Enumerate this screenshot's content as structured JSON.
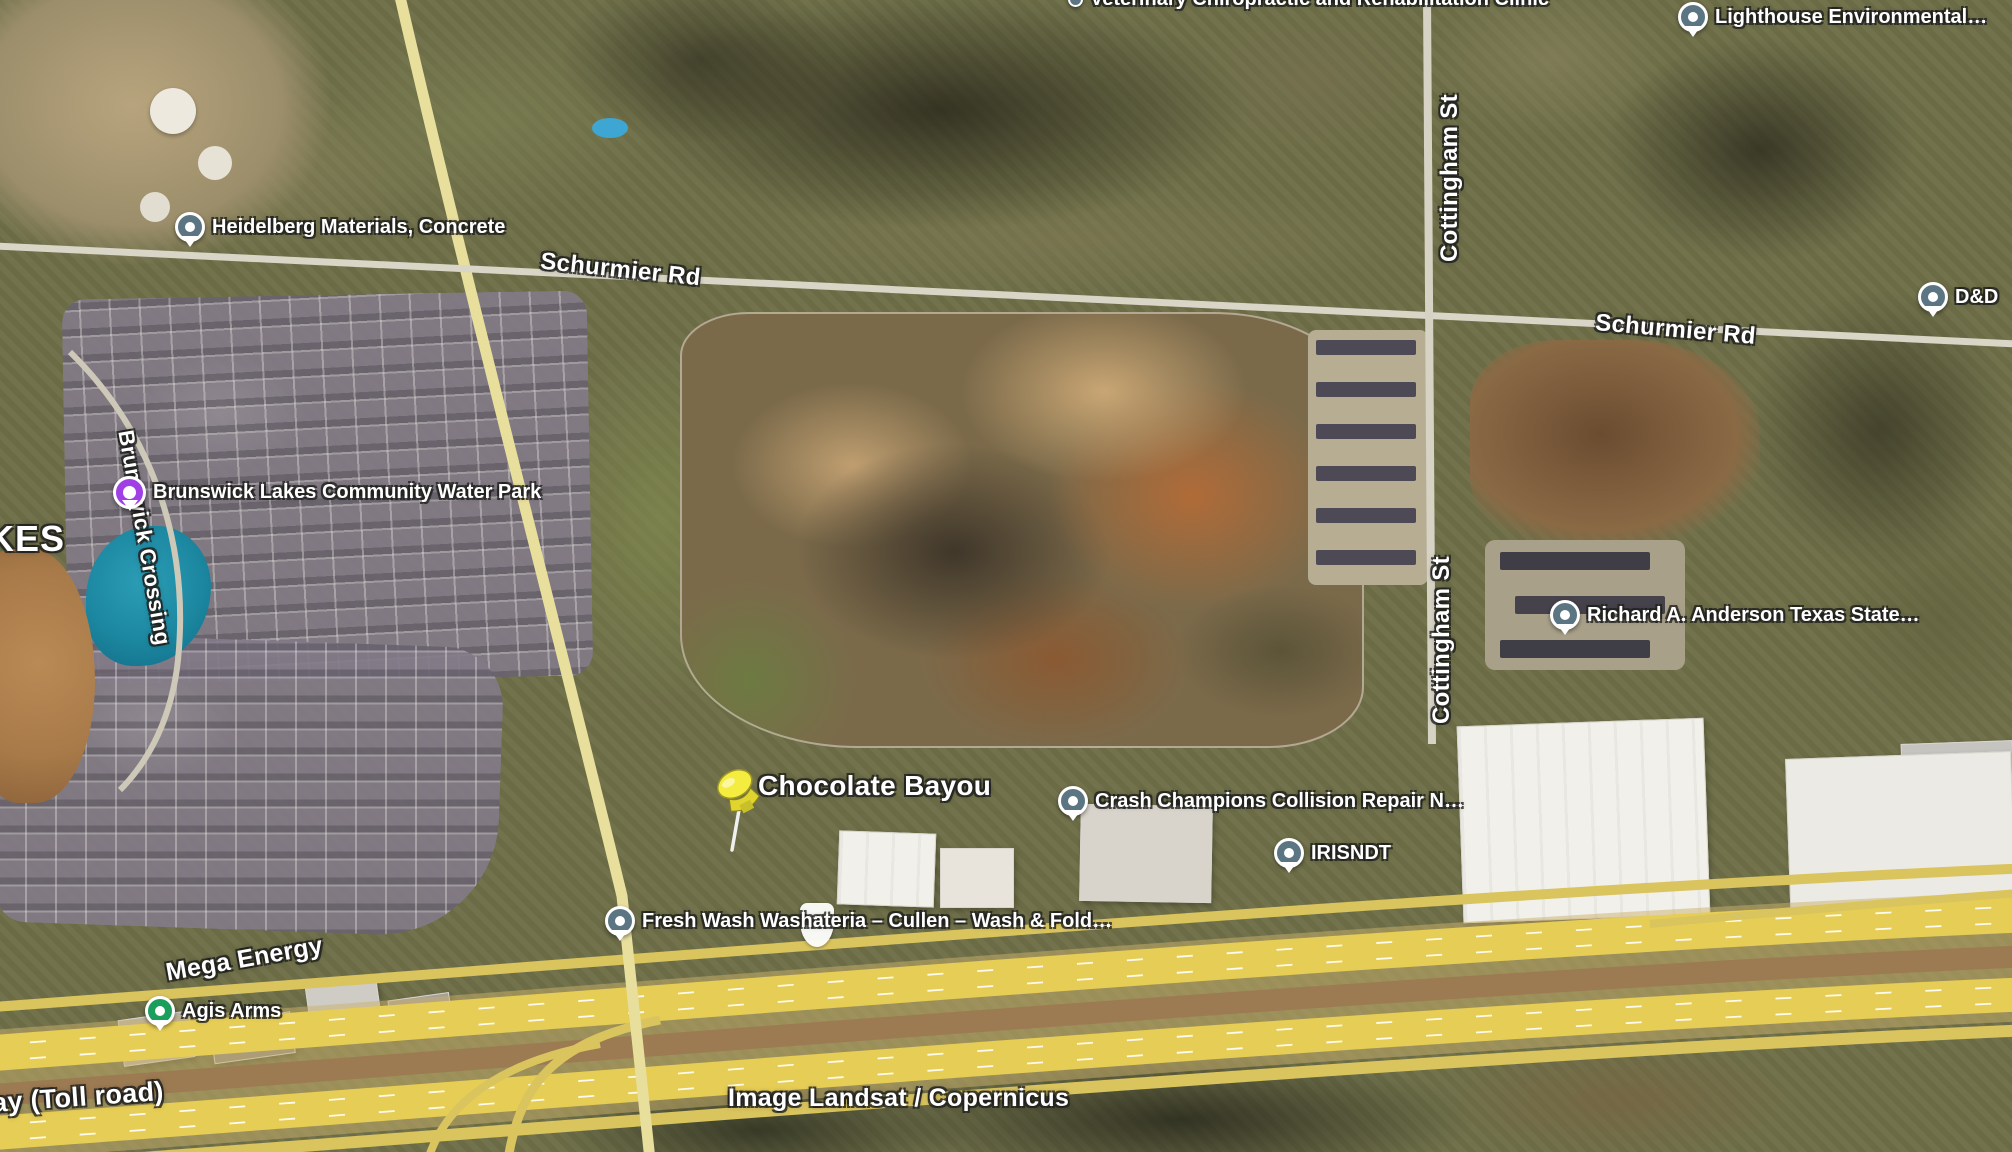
{
  "map": {
    "view": "satellite",
    "attribution": "Image Landsat / Copernicus",
    "search_result": {
      "label": "Chocolate Bayou"
    },
    "places": [
      {
        "name": "Veterinary Chiropractic and Rehabilitation Clinic",
        "pin": "slate-dot"
      },
      {
        "name": "Lighthouse Environmental…",
        "pin": "slate"
      },
      {
        "name": "Heidelberg Materials, Concrete",
        "pin": "slate"
      },
      {
        "name": "D&D",
        "pin": "slate"
      },
      {
        "name": "Brunswick Lakes Community Water Park",
        "pin": "purple"
      },
      {
        "name": "Richard A. Anderson Texas State…",
        "pin": "slate"
      },
      {
        "name": "Crash Champions Collision Repair N…",
        "pin": "slate"
      },
      {
        "name": "IRISNDT",
        "pin": "slate"
      },
      {
        "name": "Fresh Wash Washateria – Cullen – Wash & Fold…",
        "pin": "slate"
      },
      {
        "name": "Agis Arms",
        "pin": "green"
      }
    ],
    "road_labels": {
      "schurmier_west": "Schurmier Rd",
      "schurmier_east": "Schurmier Rd",
      "cottingham_north": "Cottingham St",
      "cottingham_south": "Cottingham St",
      "brunswick_crossing": "Brunswick Crossing",
      "toll_road_partial": "ay (Toll road)"
    },
    "area_labels": {
      "lakes_partial": "KES",
      "mega_energy": "Mega Energy"
    },
    "colors": {
      "pin_slate": "#5b7583",
      "pin_purple": "#a13fe6",
      "pin_green": "#1a9e5c",
      "pushpin_yellow": "#f2ea3c",
      "pond_teal": "#1c87a0",
      "pond_brown": "#a87a49",
      "highway_yellow": "#e6cd55",
      "label_text": "#ffffff"
    }
  }
}
